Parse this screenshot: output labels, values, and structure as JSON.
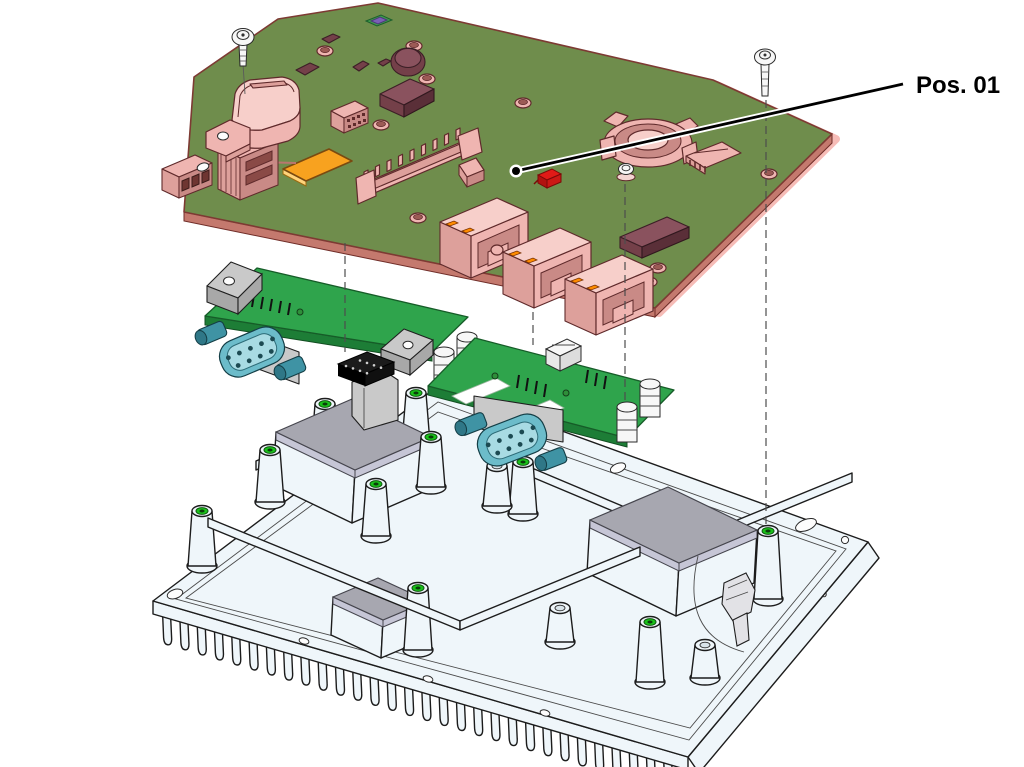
{
  "callout": {
    "label": "Pos. 01"
  },
  "colors": {
    "background": "#ffffff",
    "main_board_green": "#6f8d4c",
    "daughter_green": "#2fa44c",
    "daughter_green_dark": "#1d7d36",
    "highlight_pink": "#efb5b1",
    "highlight_pink_light": "#f7cfca",
    "highlight_pink_dark": "#dda09b",
    "highlight_outline": "#5f2a2b",
    "highlight_glow": "#f6bcb7",
    "chip_maroon": "#744049",
    "chip_maroon_dark": "#5a2f38",
    "pad_orange": "#f8a21f",
    "led_red": "#e11a17",
    "led_orange": "#ff8c00",
    "connector_teal": "#6cbcca",
    "connector_teal_dark": "#3f93a4",
    "metal_gray": "#c9c9c9",
    "metal_gray_dark": "#a8a8a8",
    "chassis_fill": "#eff6fa",
    "chassis_line": "#1c1c1c",
    "thermal_pad_top": "#a7a7b0",
    "thermal_pad_side": "#c6c6d6",
    "screw_hole_green": "#19c119",
    "socket_black": "#1b1b1b",
    "leader_line": "#000000"
  }
}
